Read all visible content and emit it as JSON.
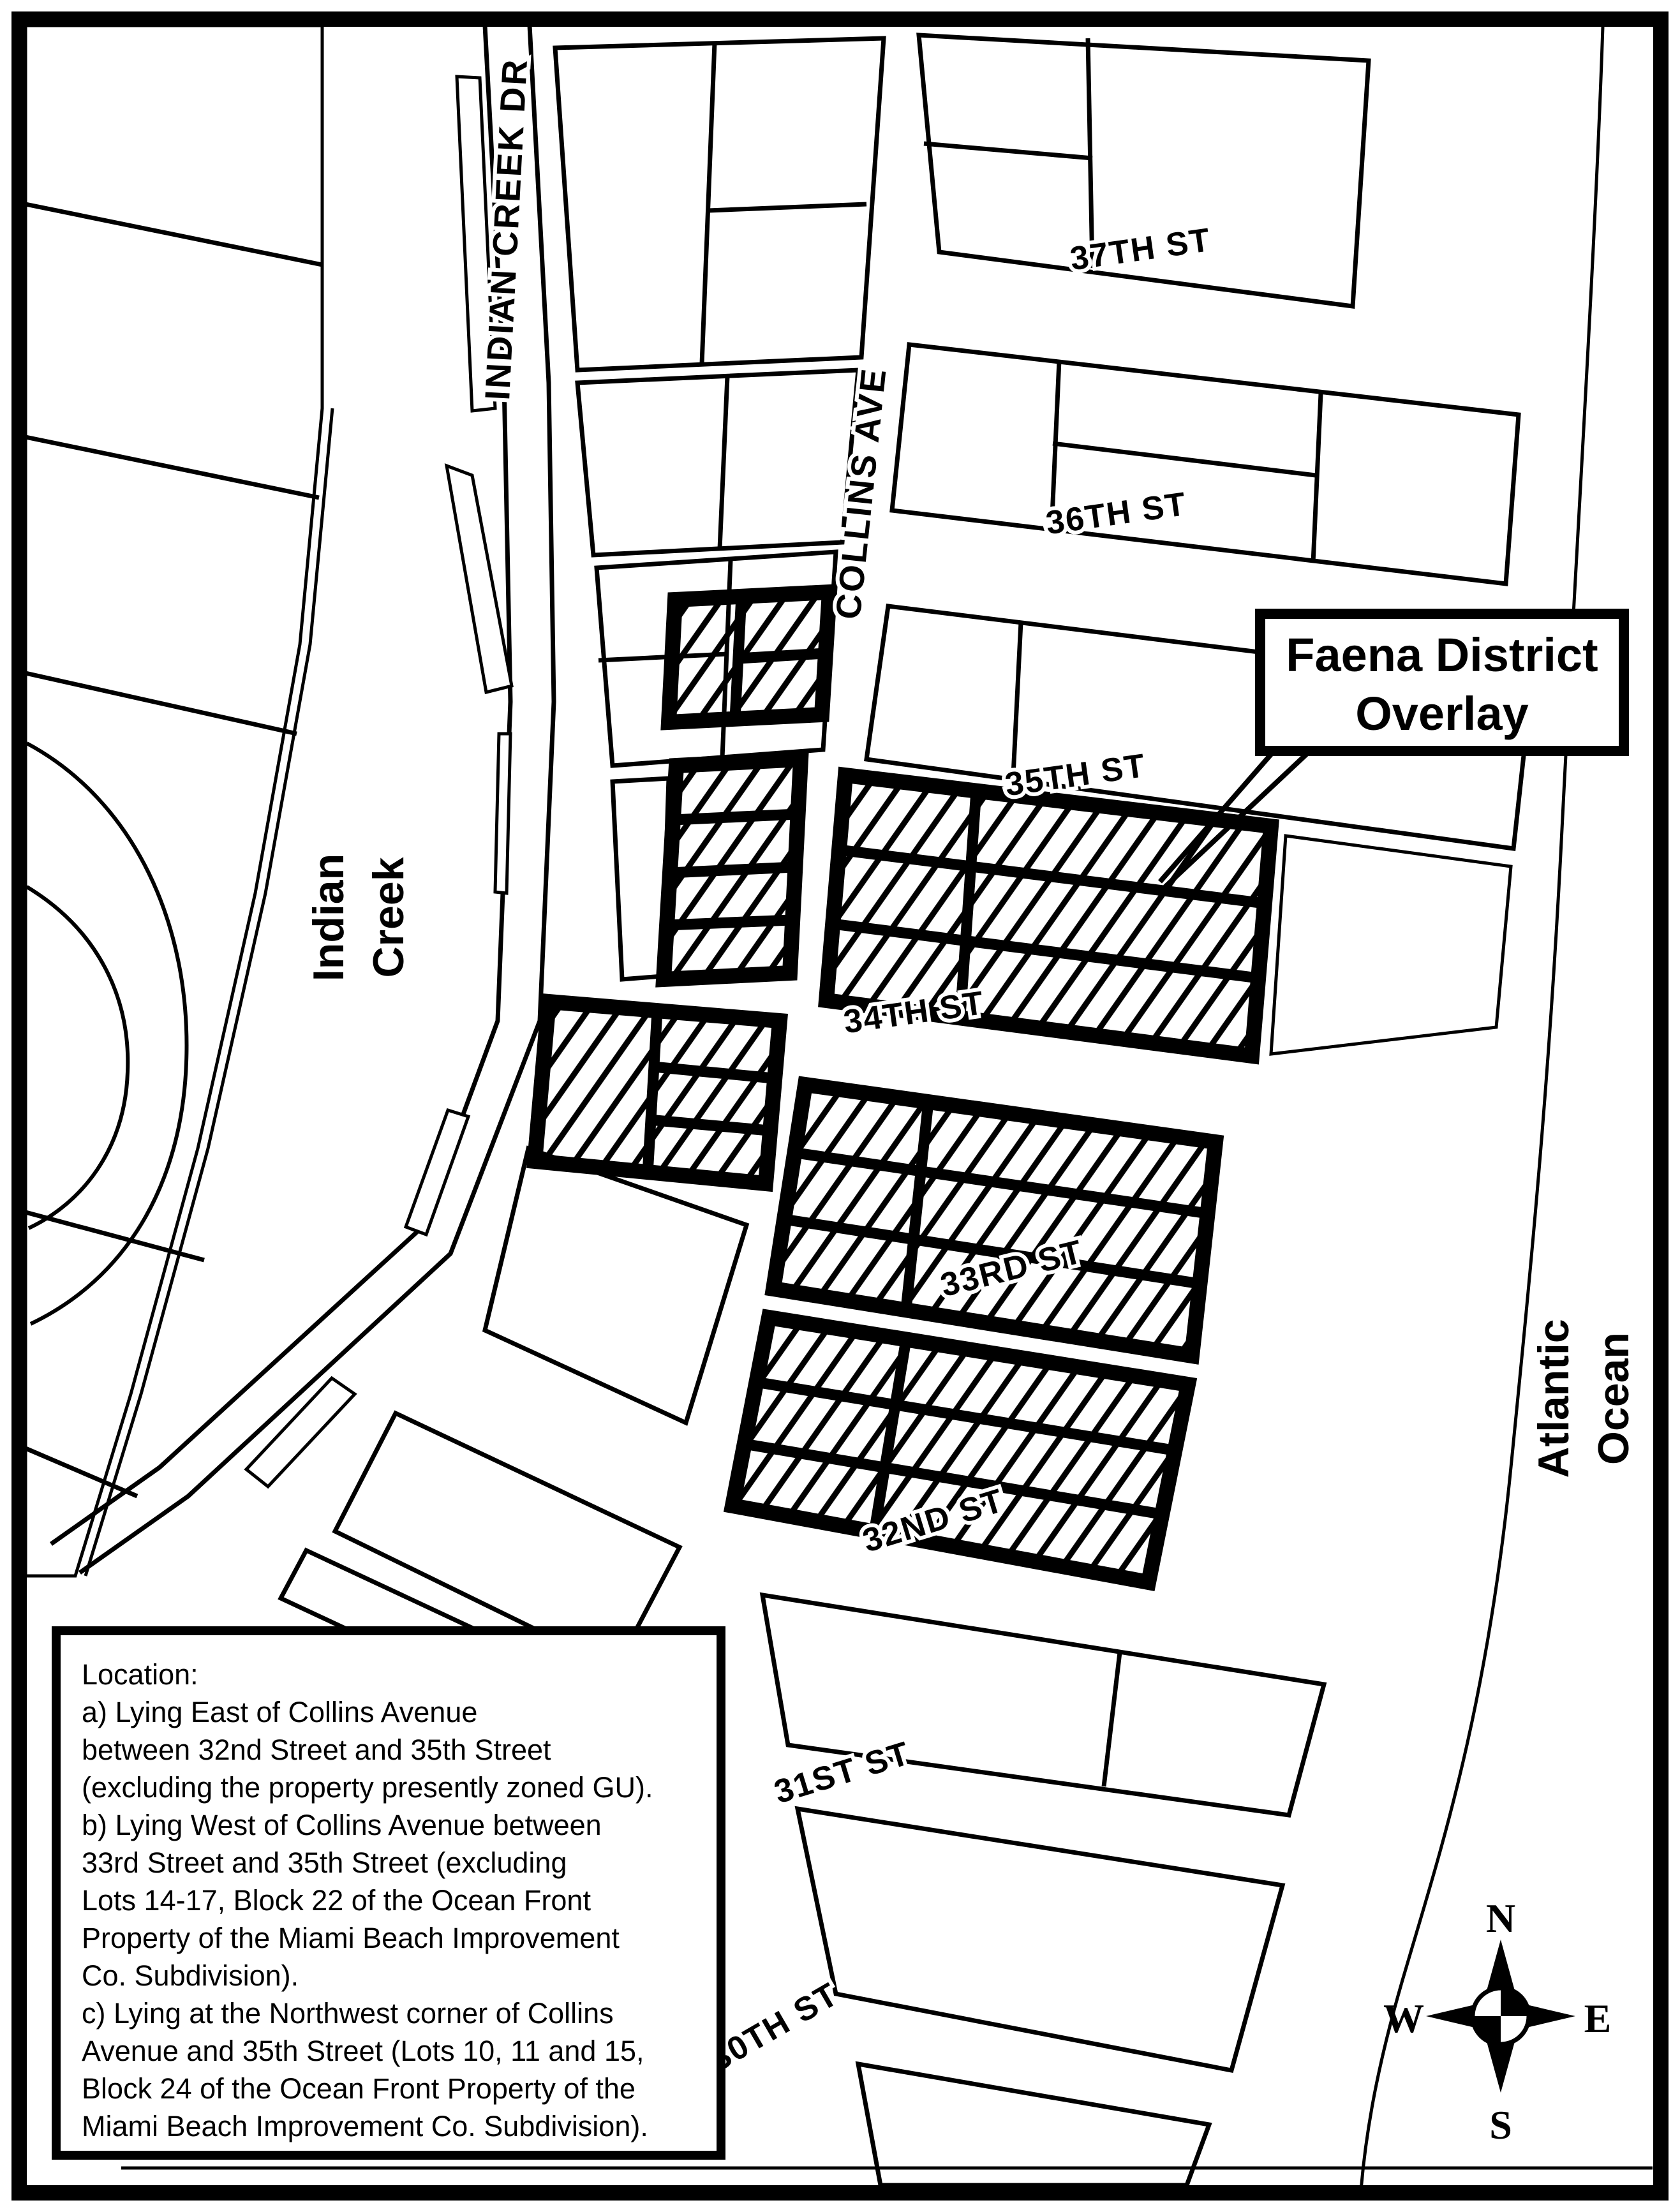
{
  "map": {
    "title_callout": {
      "line1": "Faena District",
      "line2": "Overlay"
    },
    "streets": {
      "indian_creek_dr": "INDIAN CREEK DR",
      "collins_ave": "COLLINS AVE",
      "st_37": "37TH ST",
      "st_36": "36TH ST",
      "st_35": "35TH ST",
      "st_34": "34TH ST",
      "st_33": "33RD ST",
      "st_32": "32ND ST",
      "st_31": "31ST ST",
      "st_30": "30TH ST"
    },
    "water": {
      "creek_line1": "Indian",
      "creek_line2": "Creek",
      "ocean_line1": "Atlantic",
      "ocean_line2": "Ocean"
    },
    "location_box": {
      "lines": [
        "Location:",
        "a)  Lying East of Collins Avenue",
        "between 32nd Street and 35th Street",
        "(excluding the property presently zoned GU).",
        "b)  Lying West of Collins Avenue between",
        "33rd Street and 35th Street (excluding",
        "Lots 14-17, Block 22 of the Ocean Front",
        "Property of the Miami Beach Improvement",
        "Co. Subdivision).",
        "c)  Lying at the Northwest corner of Collins",
        "Avenue and 35th Street (Lots 10, 11 and 15,",
        "Block 24 of the Ocean Front Property of the",
        "Miami Beach Improvement Co. Subdivision)."
      ]
    },
    "compass": {
      "north": "N",
      "south": "S",
      "east": "E",
      "west": "W"
    },
    "colors": {
      "ink": "#000000",
      "paper": "#ffffff"
    }
  }
}
